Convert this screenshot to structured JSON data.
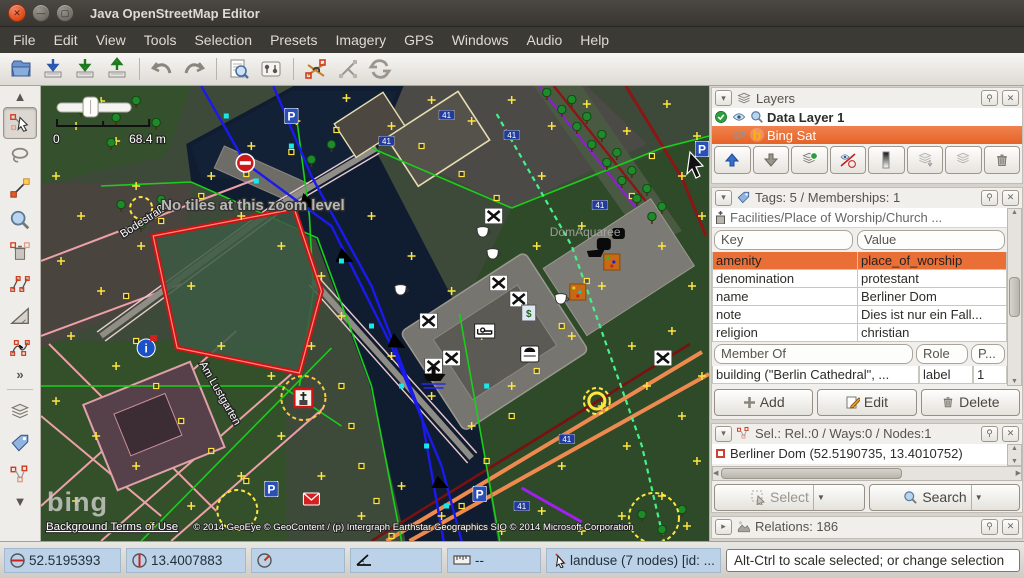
{
  "window": {
    "title": "Java OpenStreetMap Editor"
  },
  "menubar": {
    "items": [
      "File",
      "Edit",
      "View",
      "Tools",
      "Selection",
      "Presets",
      "Imagery",
      "GPS",
      "Windows",
      "Audio",
      "Help"
    ]
  },
  "map": {
    "scale_left": "0",
    "scale_right": "68.4 m",
    "no_tiles": "No tiles at this zoom level",
    "street_1": "Bodestraße",
    "street_2": "Am Lustgarten",
    "area_label": "DomAquaree",
    "route_ref": "41",
    "bing": "bing",
    "terms": "Background Terms of Use",
    "copyright": "© 2014 GeoEye © GeoContent / (p) Intergraph Earthstar Geographics SIO © 2014 Microsoft Corporation"
  },
  "layers_panel": {
    "title": "Layers",
    "layer_1": "Data Layer 1",
    "layer_2": "Bing Sat"
  },
  "tags_panel": {
    "title": "Tags: 5 / Memberships: 1",
    "preset": "Facilities/Place of Worship/Church ...",
    "col_key": "Key",
    "col_value": "Value",
    "rows": [
      {
        "k": "amenity",
        "v": "place_of_worship"
      },
      {
        "k": "denomination",
        "v": "protestant"
      },
      {
        "k": "name",
        "v": "Berliner Dom"
      },
      {
        "k": "note",
        "v": "Dies ist nur ein Fall..."
      },
      {
        "k": "religion",
        "v": "christian"
      }
    ],
    "member_col": "Member Of",
    "role_col": "Role",
    "pos_col": "P...",
    "member_row": {
      "member": "building (\"Berlin Cathedral\", ...",
      "role": "label",
      "pos": "1"
    },
    "add": "Add",
    "edit": "Edit",
    "delete": "Delete"
  },
  "selection_panel": {
    "title": "Sel.: Rel.:0 / Ways:0 / Nodes:1",
    "item": "Berliner Dom (52.5190735, 13.4010752)",
    "select": "Select",
    "search": "Search"
  },
  "relations_panel": {
    "title": "Relations: 186"
  },
  "statusbar": {
    "lat": "52.5195393",
    "lon": "13.4007883",
    "dist": "--",
    "object": "landuse (7 nodes) [id: ...",
    "help": "Alt-Ctrl to scale selected; or change selection"
  },
  "colors": {
    "selection_orange": "#e96f36",
    "status_field_blue": "#bcd2e8",
    "selected_way_red": "#c81414"
  }
}
